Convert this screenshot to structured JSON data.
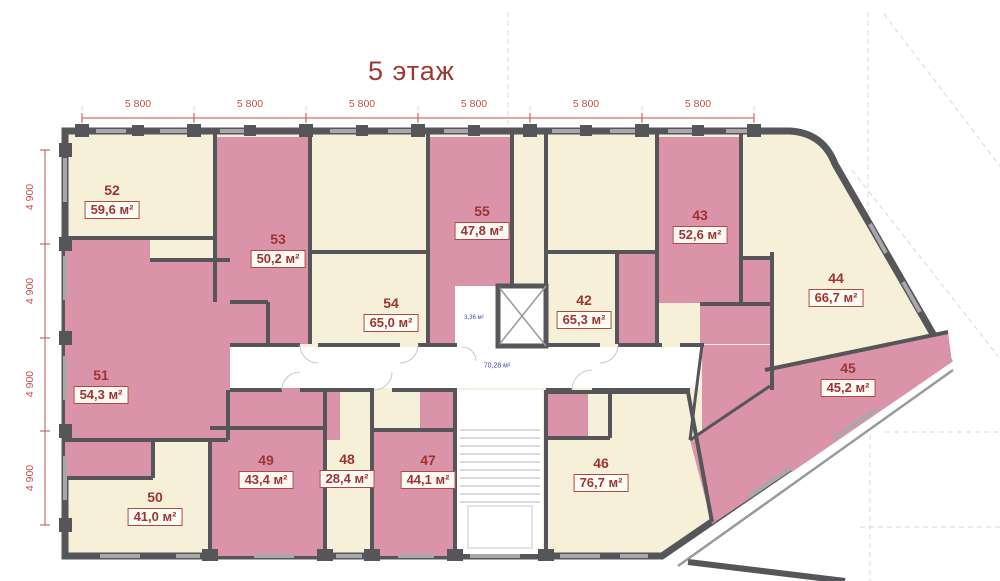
{
  "title": "5 этаж",
  "dimensions": {
    "top": [
      "5 800",
      "5 800",
      "5 800",
      "5 800",
      "5 800",
      "5 800"
    ],
    "left": [
      "4 900",
      "4 900",
      "4 900",
      "4 900"
    ]
  },
  "units": [
    {
      "number": "52",
      "area": "59,6 м²",
      "highlighted": false
    },
    {
      "number": "53",
      "area": "50,2 м²",
      "highlighted": true
    },
    {
      "number": "54",
      "area": "65,0 м²",
      "highlighted": false
    },
    {
      "number": "55",
      "area": "47,8 м²",
      "highlighted": true
    },
    {
      "number": "42",
      "area": "65,3 м²",
      "highlighted": false
    },
    {
      "number": "43",
      "area": "52,6 м²",
      "highlighted": true
    },
    {
      "number": "44",
      "area": "66,7 м²",
      "highlighted": false
    },
    {
      "number": "45",
      "area": "45,2 м²",
      "highlighted": true
    },
    {
      "number": "46",
      "area": "76,7 м²",
      "highlighted": false
    },
    {
      "number": "47",
      "area": "44,1 м²",
      "highlighted": true
    },
    {
      "number": "48",
      "area": "28,4 м²",
      "highlighted": false
    },
    {
      "number": "49",
      "area": "43,4 м²",
      "highlighted": true
    },
    {
      "number": "50",
      "area": "41,0 м²",
      "highlighted": false
    },
    {
      "number": "51",
      "area": "54,3 м²",
      "highlighted": true
    }
  ],
  "common_areas": {
    "elevator_lobby_area": "3,36 м²",
    "corridor_area": "70,28 м²"
  },
  "colors": {
    "accent_red": "#9e3430",
    "dimension_red": "#c2504a",
    "wall_gray": "#55555a",
    "room_cream": "#f6f0d9",
    "room_pink": "#db93a9",
    "area_blue": "#3f44ad"
  }
}
